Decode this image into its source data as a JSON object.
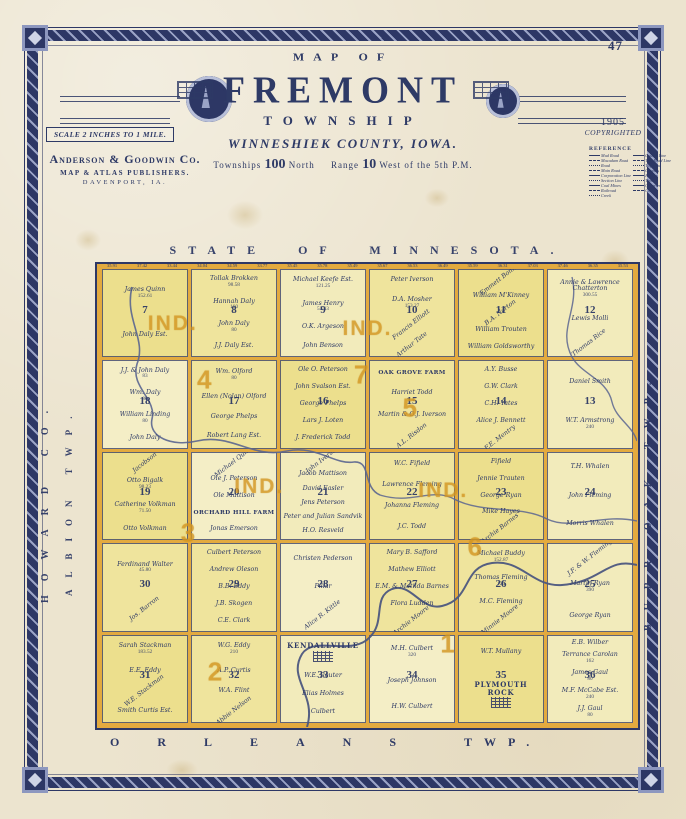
{
  "page": {
    "number": "47"
  },
  "header": {
    "arc_title": "MAP OF",
    "title": "FREMONT",
    "subtitle": "TOWNSHIP",
    "county": "WINNESHIEK COUNTY, IOWA.",
    "twp_label": "Townships",
    "twp_num": "100",
    "twp_suffix": "North",
    "range_label": "Range",
    "range_num": "10",
    "range_suffix": "West of the 5th P.M.",
    "scale": "SCALE 2 INCHES TO 1 MILE.",
    "publisher": {
      "name": "Anderson & Goodwin Co.",
      "line2": "MAP & ATLAS PUBLISHERS.",
      "line3": "DAVENPORT, IA."
    },
    "copyright": {
      "year": "1905",
      "label": "COPYRIGHTED"
    }
  },
  "reference": {
    "title": "REFERENCE",
    "left": [
      "Mud Road",
      "Macadam Road",
      "Road",
      "Main Road",
      "Corporation Line",
      "Section Line",
      "Coal Mines",
      "Railroad",
      "Creek"
    ],
    "right": [
      "County Line",
      "Twp Road Line",
      "Twp Line",
      "Country",
      "Houses",
      "Timber",
      "Quarries",
      "Church"
    ]
  },
  "margins": {
    "top": "STATE OF MINNESOTA.",
    "bottom_left": "ORLEANS",
    "bottom_right": "TWP.",
    "left_outer": "HOWARD CO.",
    "left_inner": "ALBION TWP.",
    "right": "BURR OAK TWP."
  },
  "map": {
    "lot_numbers": [
      "35.91",
      "37.42",
      "33.44",
      "34.04",
      "34.59",
      "33.77",
      "35.45",
      "35.78",
      "35.49",
      "35.67",
      "36.53",
      "36.49",
      "35.59",
      "36.31",
      "37.03",
      "37.46",
      "36.35",
      "35.53"
    ],
    "sections": [
      {
        "number": "7",
        "parcels": [
          {
            "n": "James Quinn",
            "a": "152.61"
          },
          {
            "n": "John Daly Est."
          }
        ]
      },
      {
        "number": "8",
        "parcels": [
          {
            "n": "Tollak Brokken",
            "a": "98.58"
          },
          {
            "n": "Hannah Daly",
            "a": "160"
          },
          {
            "n": "John Daly",
            "a": "80"
          },
          {
            "n": "J.J. Daly Est."
          }
        ]
      },
      {
        "number": "9",
        "parcels": [
          {
            "n": "Michael Keefe Est.",
            "a": "121.25"
          },
          {
            "n": "James Henry",
            "a": "52.33"
          },
          {
            "n": "O.K. Argeson"
          },
          {
            "n": "John Benson"
          }
        ]
      },
      {
        "number": "10",
        "parcels": [
          {
            "n": "Peter Iverson"
          },
          {
            "n": "D.A. Mosher",
            "a": "153.27"
          },
          {
            "n": "Francis Elliott",
            "rot": 1
          },
          {
            "n": "Arthur Tate",
            "rot": 1
          }
        ]
      },
      {
        "number": "11",
        "parcels": [
          {
            "n": "Emmett Bonner",
            "rot": 1
          },
          {
            "n": "William M'Kinney"
          },
          {
            "n": "B.A. Norton",
            "rot": 1
          },
          {
            "n": "William Trouten"
          },
          {
            "n": "William Goldsworthy"
          }
        ]
      },
      {
        "number": "12",
        "parcels": [
          {
            "n": "Annie & Lawrence Chatterton",
            "a": "300.55"
          },
          {
            "n": "Lewis Molli"
          },
          {
            "n": "Thomas Rice",
            "rot": 1
          }
        ]
      },
      {
        "number": "18",
        "parcels": [
          {
            "n": "J.J. & John Daly",
            "a": "83"
          },
          {
            "n": "Wm. Daly",
            "a": "80"
          },
          {
            "n": "William Linding",
            "a": "80"
          },
          {
            "n": "John Daly"
          }
        ]
      },
      {
        "number": "17",
        "parcels": [
          {
            "n": "Wm. Olford",
            "a": "80"
          },
          {
            "n": "Ellen (Nolan) Olford"
          },
          {
            "n": "George Phelps"
          },
          {
            "n": "Robert Lang Est."
          }
        ]
      },
      {
        "number": "16",
        "parcels": [
          {
            "n": "Ole O. Peterson"
          },
          {
            "n": "John Svalson Est."
          },
          {
            "n": "George Phelps"
          },
          {
            "n": "Lars J. Loten"
          },
          {
            "n": "J. Frederick Todd"
          }
        ]
      },
      {
        "number": "15",
        "parcels": [
          {
            "n": "OAK GROVE FARM",
            "t": "farm"
          },
          {
            "n": "Harriet Todd"
          },
          {
            "n": "Martin & O.J. Iverson"
          },
          {
            "n": "A.L. Risdon",
            "rot": 1
          }
        ]
      },
      {
        "number": "14",
        "parcels": [
          {
            "n": "A.Y. Busse"
          },
          {
            "n": "G.W. Clark"
          },
          {
            "n": "C.H. Yates"
          },
          {
            "n": "Alice J. Bennett"
          },
          {
            "n": "F.E. Mentry",
            "rot": 1
          }
        ]
      },
      {
        "number": "13",
        "parcels": [
          {
            "n": "Daniel Smith"
          },
          {
            "n": "W.T. Armstrong",
            "a": "240"
          }
        ]
      },
      {
        "number": "19",
        "parcels": [
          {
            "n": "Jacobson",
            "rot": 1
          },
          {
            "n": "Otto Bigalk",
            "a": "98.23"
          },
          {
            "n": "Catherine Volkman",
            "a": "71.50"
          },
          {
            "n": "Otto Volkman"
          }
        ]
      },
      {
        "number": "20",
        "parcels": [
          {
            "n": "Michael Quinn",
            "rot": 1
          },
          {
            "n": "Ole J. Peterson"
          },
          {
            "n": "Ole Mattison"
          },
          {
            "n": "ORCHARD HILL FARM",
            "t": "farm"
          },
          {
            "n": "Jonas Emerson"
          }
        ]
      },
      {
        "number": "21",
        "parcels": [
          {
            "n": "John Iverson",
            "rot": 1
          },
          {
            "n": "Jacob Mattison"
          },
          {
            "n": "David Easler"
          },
          {
            "n": "Jens Peterson"
          },
          {
            "n": "Peter and Julian Sandvik"
          },
          {
            "n": "H.O. Resveld"
          }
        ]
      },
      {
        "number": "22",
        "parcels": [
          {
            "n": "W.C. Fifield"
          },
          {
            "n": "Lawrence Fleming"
          },
          {
            "n": "Johanna Fleming"
          },
          {
            "n": "J.C. Todd"
          }
        ]
      },
      {
        "number": "23",
        "parcels": [
          {
            "n": "Fifield"
          },
          {
            "n": "Jennie Trauten"
          },
          {
            "n": "George Ryan"
          },
          {
            "n": "Mike Hayes"
          },
          {
            "n": "Archie Barnes",
            "rot": 1
          }
        ]
      },
      {
        "number": "24",
        "parcels": [
          {
            "n": "T.H. Whalen"
          },
          {
            "n": "John Fleming"
          },
          {
            "n": "Morris Whalen"
          }
        ]
      },
      {
        "number": "30",
        "parcels": [
          {
            "n": "Ferdinand Walter",
            "a": "45.80"
          },
          {
            "n": "Jos. Barron",
            "rot": 1
          }
        ]
      },
      {
        "number": "29",
        "parcels": [
          {
            "n": "Culbert Peterson"
          },
          {
            "n": "Andrew Oleson"
          },
          {
            "n": "B.B. Eddy"
          },
          {
            "n": "J.B. Skogen"
          },
          {
            "n": "C.E. Clark"
          }
        ]
      },
      {
        "number": "28",
        "parcels": [
          {
            "n": "Christen Pederson"
          },
          {
            "n": "Pillar"
          },
          {
            "n": "Alice R. Kittle",
            "rot": 1
          }
        ]
      },
      {
        "number": "27",
        "parcels": [
          {
            "n": "Mary B. Safford"
          },
          {
            "n": "Mathew Elliott"
          },
          {
            "n": "E.M. & Matilda Barnes"
          },
          {
            "n": "Flora Ludden"
          },
          {
            "n": "Archie Moore",
            "rot": 1
          }
        ]
      },
      {
        "number": "26",
        "parcels": [
          {
            "n": "Michael Buddy",
            "a": "152.87"
          },
          {
            "n": "Thomas Fleming",
            "a": "120"
          },
          {
            "n": "M.C. Fleming"
          },
          {
            "n": "Minnie Moore",
            "rot": 1
          }
        ]
      },
      {
        "number": "25",
        "parcels": [
          {
            "n": "J.F. & W. Fleming",
            "rot": 1
          },
          {
            "n": "Martin Ryan",
            "a": "390"
          },
          {
            "n": "George Ryan"
          }
        ]
      },
      {
        "number": "31",
        "parcels": [
          {
            "n": "Sarah Stackman",
            "a": "183.52"
          },
          {
            "n": "E.E. Eddy"
          },
          {
            "n": "W.E. Stackman",
            "rot": 1
          },
          {
            "n": "Smith Curtis Est."
          }
        ]
      },
      {
        "number": "32",
        "parcels": [
          {
            "n": "W.G. Eddy",
            "a": "210"
          },
          {
            "n": "A.P. Curtis"
          },
          {
            "n": "W.A. Flint"
          },
          {
            "n": "Abbie Nelson",
            "rot": 1
          }
        ]
      },
      {
        "number": "33",
        "parcels": [
          {
            "n": "KENDALLVILLE",
            "t": "village"
          },
          {
            "n": "W.E. Reuter"
          },
          {
            "n": "Elias Holmes"
          },
          {
            "n": "Culbert"
          }
        ]
      },
      {
        "number": "34",
        "parcels": [
          {
            "n": "M.H. Culbert",
            "a": "320"
          },
          {
            "n": "Joseph Johnson"
          },
          {
            "n": "H.W. Culbert"
          }
        ]
      },
      {
        "number": "35",
        "parcels": [
          {
            "n": "W.T. Mullany"
          },
          {
            "n": "PLYMOUTH ROCK",
            "t": "village"
          }
        ]
      },
      {
        "number": "36",
        "parcels": [
          {
            "n": "E.B. Wilber"
          },
          {
            "n": "Terrance Carolan",
            "a": "162"
          },
          {
            "n": "James Gaul",
            "a": "80"
          },
          {
            "n": "M.F. McCabe Est.",
            "a": "240"
          },
          {
            "n": "J.J. Gaul",
            "a": "80"
          }
        ]
      }
    ],
    "overlays": [
      {
        "text": "IND.",
        "x": 14,
        "y": 13
      },
      {
        "text": "IND.",
        "x": 50,
        "y": 14
      },
      {
        "text": "4",
        "x": 20,
        "y": 25
      },
      {
        "text": "7",
        "x": 49,
        "y": 24
      },
      {
        "text": "5",
        "x": 58,
        "y": 31
      },
      {
        "text": "IND.",
        "x": 30,
        "y": 48
      },
      {
        "text": "3",
        "x": 17,
        "y": 58
      },
      {
        "text": "IND.",
        "x": 64,
        "y": 49
      },
      {
        "text": "6",
        "x": 70,
        "y": 61
      },
      {
        "text": "2",
        "x": 22,
        "y": 88
      },
      {
        "text": "1",
        "x": 65,
        "y": 82
      }
    ]
  },
  "colors": {
    "ink": "#2e3a66",
    "frame": "#2d3765",
    "road_orange": "#e3aa3f",
    "parcel_yellow": "#efe49d",
    "paper": "#ece4cf",
    "stream": "#5a6590"
  }
}
